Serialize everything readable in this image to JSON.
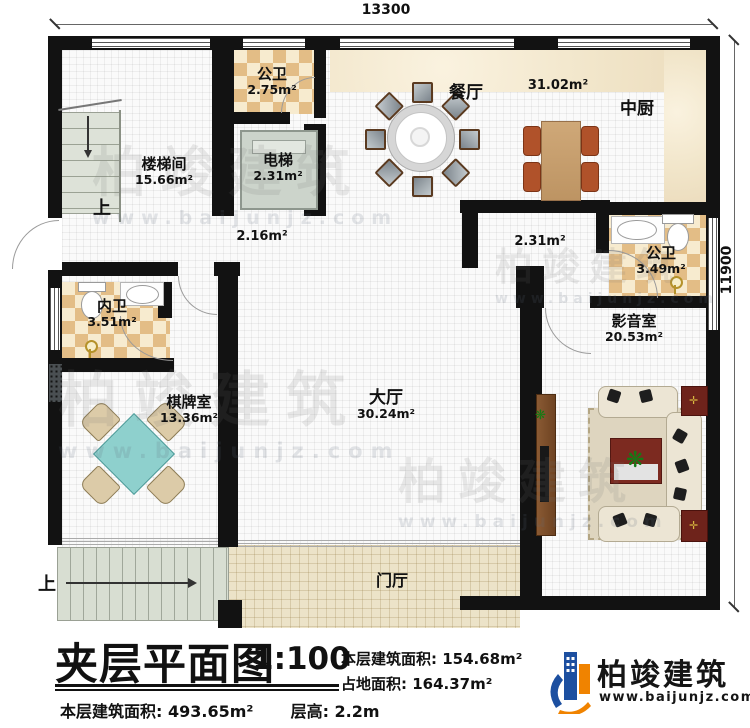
{
  "plan": {
    "dimensions": {
      "top": "13300",
      "right": "11900"
    },
    "rooms": {
      "gongwei_top": {
        "name": "公卫",
        "area": "2.75m²"
      },
      "louti": {
        "name": "楼梯间",
        "area": "15.66m²"
      },
      "dianti": {
        "name": "电梯",
        "area": "2.31m²"
      },
      "canting": {
        "name": "餐厅",
        "area": "31.02m²"
      },
      "zhongchu": {
        "name": "中厨"
      },
      "gongwei_right": {
        "name": "公卫",
        "area": "3.49m²"
      },
      "neiwei": {
        "name": "内卫",
        "area": "3.51m²"
      },
      "qipaishi": {
        "name": "棋牌室",
        "area": "13.36m²"
      },
      "dating": {
        "name": "大厅",
        "area": "30.24m²"
      },
      "yingyinshi": {
        "name": "影音室",
        "area": "20.53m²"
      },
      "menting": {
        "name": "门厅"
      }
    },
    "corridor_areas": {
      "left": "2.16m²",
      "right": "2.31m²"
    },
    "stairs": {
      "up_top": "上",
      "up_bottom": "上"
    }
  },
  "title_block": {
    "title": "夹层平面图",
    "scale": "1:100",
    "floor_area_label": "本层建筑面积:",
    "floor_area_value": "154.68m²",
    "footprint_label": "占地面积:",
    "footprint_value": "164.37m²",
    "total_area_label": "本层建筑面积:",
    "total_area_value": "493.65m²",
    "height_label": "层高:",
    "height_value": "2.2m"
  },
  "brand": {
    "name": "柏竣建筑",
    "website": "www.baijunjz.com"
  },
  "watermark": {
    "name": "柏竣建筑",
    "website": "www.baijunjz.com"
  },
  "colors": {
    "wall": "#121212",
    "checker": "#e3bd86",
    "teal_table": "#8ed0cd",
    "brand_blue": "#1c4fa0",
    "brand_orange": "#f08300"
  }
}
